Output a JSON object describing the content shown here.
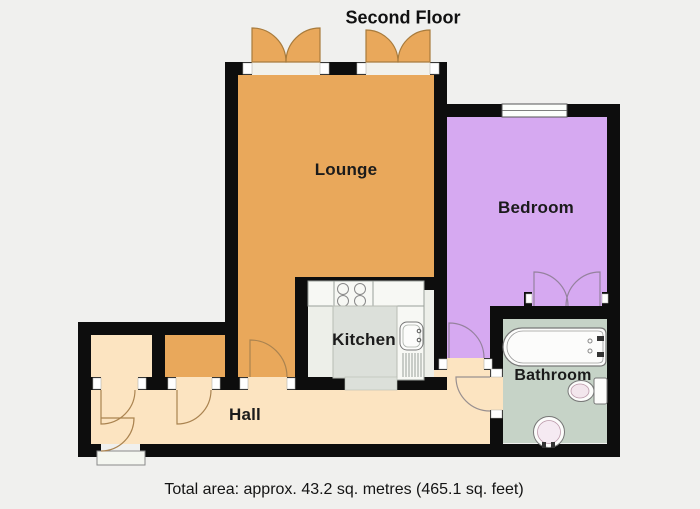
{
  "title": "Second Floor",
  "caption": "Total area: approx. 43.2 sq. metres (465.1 sq. feet)",
  "rooms": {
    "lounge": {
      "label": "Lounge"
    },
    "bedroom": {
      "label": "Bedroom"
    },
    "kitchen": {
      "label": "Kitchen"
    },
    "bathroom": {
      "label": "Bathroom"
    },
    "hall": {
      "label": "Hall"
    }
  },
  "colors": {
    "background": "#f0f0ee",
    "wall": "#0d0d0d",
    "lounge": "#e9a85b",
    "bedroom": "#d6a9f1",
    "hall": "#fce4c1",
    "kitchen_floor": "#edefe9",
    "kitchen_counter": "#f7f8f4",
    "kitchen_island": "#dce0da",
    "bathroom": "#c6d3c7",
    "fixture": "#fcfcfb"
  }
}
